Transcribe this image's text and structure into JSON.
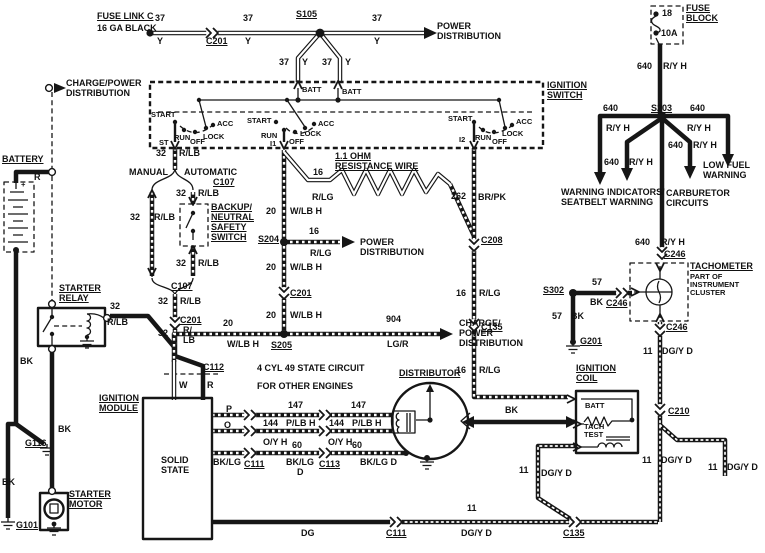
{
  "colors": {
    "ink": "#161616",
    "paper": "#ffffff"
  },
  "wire_labels": {
    "n37": "37",
    "y": "Y",
    "n18": "18",
    "n10a": "10A",
    "n640": "640",
    "ryh": "R/Y H",
    "n32": "32",
    "rlb": "R/LB",
    "r_lb": "R/\nLB",
    "n20": "20",
    "wlbh": "W/LB H",
    "n16": "16",
    "rlg": "R/LG",
    "n262": "262",
    "brpk": "BR/PK",
    "n904": "904",
    "lgr": "LG/R",
    "n57": "57",
    "bk": "BK",
    "n11": "11",
    "dgyd": "DG/Y D",
    "dg": "DG",
    "n147": "147",
    "n144": "144",
    "n60": "60",
    "plbh": "P/LB H",
    "oyh": "O/Y H",
    "bklg": "BK/LG",
    "bklgd": "BK/LG D",
    "d": "D",
    "p": "P",
    "o": "O",
    "w": "W",
    "r": "R"
  },
  "connectors": {
    "c201": "C201",
    "s105": "S105",
    "s203": "S203",
    "s204": "S204",
    "s205": "S205",
    "s302": "S302",
    "c107": "C107",
    "c112": "C112",
    "c111": "C111",
    "c113": "C113",
    "c208": "C208",
    "c135": "C135",
    "c246": "C246",
    "c210": "C210",
    "g101": "G101",
    "g116": "G116",
    "g201": "G201"
  },
  "components": {
    "fuse_link_c": "FUSE LINK C",
    "ga16_black": "16 GA BLACK",
    "power_distribution": "POWER\nDISTRIBUTION",
    "charge_power_distribution": "CHARGE/POWER\nDISTRIBUTION",
    "charge_power_distribution_3": "CHARGE/\nPOWER\nDISTRIBUTION",
    "fuse_block": "FUSE\nBLOCK",
    "ignition_switch": "IGNITION\nSWITCH",
    "battery": "BATTERY",
    "starter_relay": "STARTER\nRELAY",
    "starter_motor": "STARTER\nMOTOR",
    "manual": "MANUAL",
    "automatic": "AUTOMATIC",
    "backup_neutral": "BACKUP/\nNEUTRAL\nSAFETY\nSWITCH",
    "resistance_wire": "1.1 OHM\nRESISTANCE WIRE",
    "warning_seatbelt": "WARNING INDICATORS/\nSEATBELT WARNING",
    "carburetor_circuits": "CARBURETOR\nCIRCUITS",
    "low_fuel_warning": "LOW FUEL\nWARNING",
    "tachometer": "TACHOMETER",
    "tach_note": "PART OF\nINSTRUMENT\nCLUSTER",
    "ignition_coil": "IGNITION\nCOIL",
    "distributor": "DISTRIBUTOR",
    "ignition_module": "IGNITION\nMODULE",
    "solid_state": "SOLID\nSTATE",
    "circuit_note1": "4 CYL 49 STATE CIRCUIT",
    "circuit_note2": "FOR OTHER ENGINES",
    "batt": "BATT",
    "tach_test": "TACH\nTEST",
    "start": "START",
    "run": "RUN",
    "off": "OFF",
    "lock": "LOCK",
    "acc": "ACC",
    "st": "ST",
    "i1": "I1",
    "i2": "I2",
    "plus": "+"
  }
}
